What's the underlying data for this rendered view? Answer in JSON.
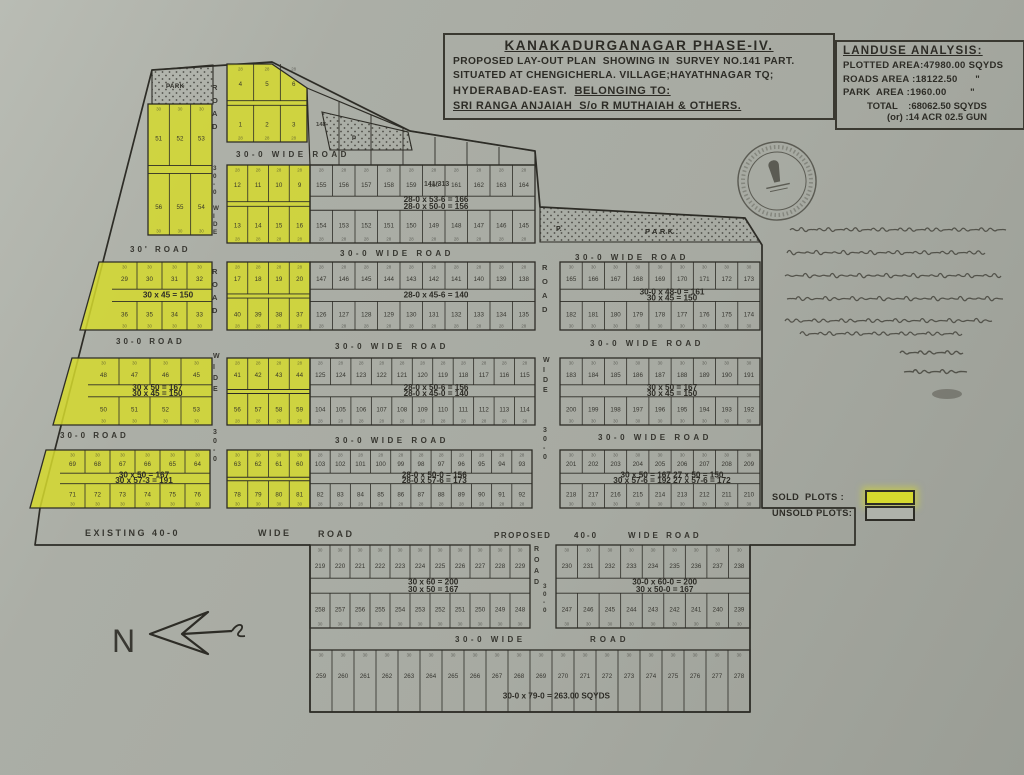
{
  "title_block": {
    "l1": "KANAKADURGANAGAR  PHASE-IV.",
    "l2": "PROPOSED LAY-OUT PLAN  SHOWING IN  SURVEY NO.141 PART.",
    "l3": "SITUATED AT CHENGICHERLA. VILLAGE;HAYATHNAGAR TQ;",
    "l4a": "HYDERABAD-EAST.  ",
    "l4b": "BELONGING TO:",
    "l5": "SRI RANGA ANJAIAH  S/o R MUTHAIAH & OTHERS."
  },
  "landuse": {
    "title": "LANDUSE ANALYSIS:",
    "rows": [
      "PLOTTED AREA:47980.00 SQYDS",
      "ROADS AREA :18122.50      \"",
      "PARK  AREA :1960.00        \""
    ],
    "total": "TOTAL    :68062.50 SQYDS",
    "alt": "(or) :14 ACR 02.5 GUN"
  },
  "legend": {
    "sold": "SOLD  PLOTS :",
    "unsold": "UNSOLD PLOTS:"
  },
  "compass": {
    "letter": "N"
  },
  "stamp": {
    "description": "circular official seal with pillar emblem"
  },
  "handwriting": {
    "description": "handwritten Telugu annotation referencing survey no.141, areas 47980, 18122.50, 1960.00 sq.yds, with signature and date",
    "lines": [
      [
        790,
        230,
        218
      ],
      [
        787,
        253,
        205
      ],
      [
        785,
        276,
        224
      ],
      [
        787,
        299,
        216
      ],
      [
        785,
        321,
        212
      ],
      [
        800,
        334,
        162
      ]
    ],
    "signature": [
      [
        900,
        353,
        70
      ],
      [
        904,
        372,
        64
      ]
    ]
  },
  "map": {
    "ink": "#2d2c26",
    "sold_color": "#d5d92e",
    "boundary": "M152,70 L272,62 L410,131 L535,151 L540,207 L745,218 L762,245 L762,508 L855,508 L855,545 L750,545 L750,712 L310,712 L310,545 L35,545 L40,508 Z",
    "parks": [
      {
        "pts": "152,70 213,65 213,104 152,104",
        "labels": [
          {
            "t": "PARK",
            "x": 166,
            "y": 88,
            "fs": 6,
            "ls": 0.5
          }
        ]
      },
      {
        "pts": "322,112 408,132 412,150 330,150",
        "labels": [
          {
            "t": "P",
            "x": 352,
            "y": 140,
            "fs": 6,
            "ls": 0
          }
        ]
      },
      {
        "pts": "540,207 745,218 760,242 540,242",
        "labels": [
          {
            "t": "P.",
            "x": 556,
            "y": 231,
            "fs": 7,
            "ls": 0
          },
          {
            "t": "PARK.",
            "x": 645,
            "y": 234,
            "fs": 7.5,
            "ls": 2.5
          }
        ]
      }
    ],
    "strip": {
      "pts": "307,88 410,131 535,151 535,165 310,165",
      "lines": [
        [
          339,
          102
        ],
        [
          371,
          115
        ],
        [
          403,
          128
        ],
        [
          435,
          137
        ],
        [
          467,
          142
        ],
        [
          499,
          147
        ]
      ],
      "y2": 165
    },
    "blocks": [
      {
        "n": "top-mid",
        "pts": "227,64 272,64 307,88 307,142 227,142",
        "gx": 227,
        "gy": 64,
        "gw": 80,
        "gh": 78,
        "cols": 3,
        "sold": 1,
        "front": "28",
        "rows": [
          [
            "4",
            "5",
            "6"
          ],
          [
            "1",
            "2",
            "3"
          ]
        ],
        "anns": []
      },
      {
        "n": "lb1",
        "gx": 148,
        "gy": 104,
        "gw": 64,
        "gh": 131,
        "cols": 3,
        "sold": 1,
        "front": "30",
        "rows": [
          [
            "51",
            "52",
            "53"
          ],
          [
            "56",
            "55",
            "54"
          ]
        ],
        "anns": []
      },
      {
        "n": "rowB-yellow",
        "gx": 227,
        "gy": 165,
        "gw": 83,
        "gh": 78,
        "cols": 4,
        "sold": 1,
        "front": "28",
        "rows": [
          [
            "12",
            "11",
            "10",
            "9"
          ],
          [
            "13",
            "14",
            "15",
            "16"
          ]
        ],
        "anns": []
      },
      {
        "n": "M2",
        "gx": 310,
        "gy": 165,
        "gw": 225,
        "gh": 78,
        "cols": 10,
        "front": "28",
        "rows": [
          [
            "155",
            "156",
            "157",
            "158",
            "159",
            "160",
            "161",
            "162",
            "163",
            "164"
          ],
          [
            "154",
            "153",
            "152",
            "151",
            "150",
            "149",
            "148",
            "147",
            "146",
            "145"
          ]
        ],
        "anns": [
          "28-0 x 53-6 = 166",
          "28-0 x 50-0 = 156"
        ]
      },
      {
        "n": "lb2",
        "pts": "99,262 212,262 212,330 80,330",
        "gx": 112,
        "gy": 262,
        "gw": 100,
        "gh": 68,
        "cols": 4,
        "sold": 1,
        "front": "30",
        "rows": [
          [
            "29",
            "30",
            "31",
            "32"
          ],
          [
            "36",
            "35",
            "34",
            "33"
          ]
        ],
        "anns": [
          "30 x 45 = 150"
        ]
      },
      {
        "n": "rowC-yellow",
        "gx": 227,
        "gy": 262,
        "gw": 83,
        "gh": 68,
        "cols": 4,
        "sold": 1,
        "front": "28",
        "rows": [
          [
            "17",
            "18",
            "19",
            "20"
          ],
          [
            "40",
            "39",
            "38",
            "37"
          ]
        ],
        "anns": []
      },
      {
        "n": "M3",
        "gx": 310,
        "gy": 262,
        "gw": 225,
        "gh": 68,
        "cols": 10,
        "front": "28",
        "rows": [
          [
            "147",
            "146",
            "145",
            "144",
            "143",
            "142",
            "141",
            "140",
            "139",
            "138"
          ],
          [
            "126",
            "127",
            "128",
            "129",
            "130",
            "131",
            "132",
            "133",
            "134",
            "135"
          ]
        ],
        "anns": [
          "28-0 x 45-6 = 140"
        ]
      },
      {
        "n": "RB1",
        "gx": 560,
        "gy": 262,
        "gw": 200,
        "gh": 68,
        "cols": 9,
        "front": "30",
        "rows": [
          [
            "165",
            "166",
            "167",
            "168",
            "169",
            "170",
            "171",
            "172",
            "173"
          ],
          [
            "182",
            "181",
            "180",
            "179",
            "178",
            "177",
            "176",
            "175",
            "174"
          ]
        ],
        "anns": [
          "30-0 x 48-0 = 161",
          "30 x 45 = 150"
        ]
      },
      {
        "n": "lb3",
        "pts": "72,358 212,358 212,425 53,425",
        "gx": 88,
        "gy": 358,
        "gw": 124,
        "gh": 67,
        "cols": 4,
        "sold": 1,
        "front": "30",
        "rows": [
          [
            "48",
            "47",
            "46",
            "45"
          ],
          [
            "50",
            "51",
            "52",
            "53"
          ]
        ],
        "anns": [
          "30 x 50 = 167",
          "30 x 45 = 150"
        ]
      },
      {
        "n": "rowD-yellow",
        "gx": 227,
        "gy": 358,
        "gw": 83,
        "gh": 67,
        "cols": 4,
        "sold": 1,
        "front": "28",
        "rows": [
          [
            "41",
            "42",
            "43",
            "44"
          ],
          [
            "56",
            "57",
            "58",
            "59"
          ]
        ],
        "anns": []
      },
      {
        "n": "M4",
        "gx": 310,
        "gy": 358,
        "gw": 225,
        "gh": 67,
        "cols": 11,
        "front": "28",
        "rows": [
          [
            "125",
            "124",
            "123",
            "122",
            "121",
            "120",
            "119",
            "118",
            "117",
            "116",
            "115"
          ],
          [
            "104",
            "105",
            "106",
            "107",
            "108",
            "109",
            "110",
            "111",
            "112",
            "113",
            "114"
          ]
        ],
        "anns": [
          "28-0 x 50-6 = 156",
          "28-0 x 45-0 = 140"
        ]
      },
      {
        "n": "RB2",
        "gx": 560,
        "gy": 358,
        "gw": 200,
        "gh": 67,
        "cols": 9,
        "front": "30",
        "rows": [
          [
            "183",
            "184",
            "185",
            "186",
            "187",
            "188",
            "189",
            "190",
            "191"
          ],
          [
            "200",
            "199",
            "198",
            "197",
            "196",
            "195",
            "194",
            "193",
            "192"
          ]
        ],
        "anns": [
          "30 x 50 = 167",
          "30 x 45 = 150"
        ]
      },
      {
        "n": "lb4",
        "pts": "46,450 210,450 210,508 30,508",
        "gx": 60,
        "gy": 450,
        "gw": 150,
        "gh": 58,
        "cols": 6,
        "sold": 1,
        "front": "30",
        "rows": [
          [
            "69",
            "68",
            "67",
            "66",
            "65",
            "64"
          ],
          [
            "71",
            "72",
            "73",
            "74",
            "75",
            "76"
          ]
        ],
        "anns": [
          "30 x 50 = 167",
          "30 x 57-3 = 191"
        ]
      },
      {
        "n": "lb5",
        "gx": 227,
        "gy": 450,
        "gw": 83,
        "gh": 58,
        "cols": 4,
        "sold": 1,
        "front": "30",
        "rows": [
          [
            "63",
            "62",
            "61",
            "60"
          ],
          [
            "78",
            "79",
            "80",
            "81"
          ]
        ],
        "anns": []
      },
      {
        "n": "M5",
        "gx": 310,
        "gy": 450,
        "gw": 222,
        "gh": 58,
        "cols": 11,
        "front": "28",
        "rows": [
          [
            "103",
            "102",
            "101",
            "100",
            "99",
            "98",
            "97",
            "96",
            "95",
            "94",
            "93"
          ],
          [
            "82",
            "83",
            "84",
            "85",
            "86",
            "87",
            "88",
            "89",
            "90",
            "91",
            "92"
          ]
        ],
        "anns": [
          "28-0 x 50-0 = 156",
          "28-0 x 57-6 = 173"
        ]
      },
      {
        "n": "RB3",
        "gx": 560,
        "gy": 450,
        "gw": 200,
        "gh": 58,
        "cols": 9,
        "front": "30",
        "rows": [
          [
            "201",
            "202",
            "203",
            "204",
            "205",
            "206",
            "207",
            "208",
            "209"
          ],
          [
            "218",
            "217",
            "216",
            "215",
            "214",
            "213",
            "212",
            "211",
            "210"
          ]
        ],
        "anns": [
          "30 x 50 = 167   27 x 50 = 150",
          "30 x 57-6 = 192  27 x 57-6 = 172"
        ]
      },
      {
        "n": "BB1",
        "gx": 310,
        "gy": 545,
        "gw": 220,
        "gh": 83,
        "cols": 11,
        "front": "30",
        "rows": [
          [
            "219",
            "220",
            "221",
            "222",
            "223",
            "224",
            "225",
            "226",
            "227",
            "228",
            "229"
          ],
          [
            "258",
            "257",
            "256",
            "255",
            "254",
            "253",
            "252",
            "251",
            "250",
            "249",
            "248"
          ]
        ],
        "anns": [
          "30 x 60 = 200",
          "30 x 50 = 167"
        ]
      },
      {
        "n": "BB2",
        "gx": 556,
        "gy": 545,
        "gw": 194,
        "gh": 83,
        "cols": 9,
        "front": "30",
        "rows": [
          [
            "230",
            "231",
            "232",
            "233",
            "234",
            "235",
            "236",
            "237",
            "238"
          ],
          [
            "247",
            "246",
            "245",
            "244",
            "243",
            "242",
            "241",
            "240",
            "239"
          ]
        ],
        "anns": [
          "30-0 x 60-0 = 200",
          "30 x 50-0 = 167"
        ]
      },
      {
        "n": "BB3",
        "gx": 310,
        "gy": 650,
        "gw": 440,
        "gh": 62,
        "cols": 20,
        "front": "30",
        "rows": [
          [
            "259",
            "260",
            "261",
            "262",
            "263",
            "264",
            "265",
            "266",
            "267",
            "268",
            "269",
            "270",
            "271",
            "272",
            "273",
            "274",
            "275",
            "276",
            "277",
            "278"
          ]
        ],
        "anns": [
          "30-0 x 79-0 = 263.00 SQYDS"
        ]
      }
    ],
    "road_labels": [
      {
        "t": "30-0  WIDE  ROAD",
        "x": 236,
        "y": 157,
        "fs": 8,
        "ls": 3.5
      },
      {
        "t": "30'  ROAD",
        "x": 130,
        "y": 252,
        "fs": 8,
        "ls": 3
      },
      {
        "t": "30-0  WIDE  ROAD",
        "x": 340,
        "y": 256,
        "fs": 8,
        "ls": 3.5
      },
      {
        "t": "30-0  WIDE  ROAD",
        "x": 575,
        "y": 260,
        "fs": 8,
        "ls": 3.5
      },
      {
        "t": "30-0  ROAD",
        "x": 116,
        "y": 344,
        "fs": 8,
        "ls": 3
      },
      {
        "t": "30-0  WIDE  ROAD",
        "x": 335,
        "y": 349,
        "fs": 8,
        "ls": 3.5
      },
      {
        "t": "30-0  WIDE  ROAD",
        "x": 590,
        "y": 346,
        "fs": 8,
        "ls": 3.5
      },
      {
        "t": "30-0  ROAD",
        "x": 60,
        "y": 438,
        "fs": 8,
        "ls": 3
      },
      {
        "t": "30-0  WIDE  ROAD",
        "x": 335,
        "y": 443,
        "fs": 8,
        "ls": 3.5
      },
      {
        "t": "30-0  WIDE  ROAD",
        "x": 598,
        "y": 440,
        "fs": 8,
        "ls": 3.5
      },
      {
        "t": "EXISTING  40-0",
        "x": 85,
        "y": 536,
        "fs": 9,
        "ls": 2.5
      },
      {
        "t": "WIDE",
        "x": 258,
        "y": 536,
        "fs": 9,
        "ls": 2.5
      },
      {
        "t": "ROAD",
        "x": 318,
        "y": 537,
        "fs": 9,
        "ls": 2.5
      },
      {
        "t": "PROPOSED",
        "x": 494,
        "y": 538,
        "fs": 8,
        "ls": 1.5
      },
      {
        "t": "40-0",
        "x": 574,
        "y": 538,
        "fs": 8,
        "ls": 2
      },
      {
        "t": "WIDE  ROAD",
        "x": 628,
        "y": 538,
        "fs": 8,
        "ls": 3
      },
      {
        "t": "30-0  WIDE",
        "x": 455,
        "y": 642,
        "fs": 8,
        "ls": 3.5
      },
      {
        "t": "ROAD",
        "x": 590,
        "y": 642,
        "fs": 8,
        "ls": 4
      },
      {
        "t": "ROAD",
        "x": 212,
        "y": 90,
        "fs": 7.5,
        "vert": 1,
        "step": 13
      },
      {
        "t": "30-0 WIDE",
        "x": 213,
        "y": 170,
        "fs": 6.3,
        "vert": 1,
        "step": 8
      },
      {
        "t": "ROAD",
        "x": 212,
        "y": 274,
        "fs": 7.5,
        "vert": 1,
        "step": 13
      },
      {
        "t": "WIDE",
        "x": 213,
        "y": 358,
        "fs": 7,
        "vert": 1,
        "step": 11
      },
      {
        "t": "30-0",
        "x": 213,
        "y": 434,
        "fs": 7,
        "vert": 1,
        "step": 9
      },
      {
        "t": "ROAD",
        "x": 542,
        "y": 270,
        "fs": 7.5,
        "vert": 1,
        "step": 14
      },
      {
        "t": "WIDE",
        "x": 543,
        "y": 362,
        "fs": 7,
        "vert": 1,
        "step": 10
      },
      {
        "t": "30-0",
        "x": 543,
        "y": 432,
        "fs": 7,
        "vert": 1,
        "step": 9
      },
      {
        "t": "ROAD",
        "x": 534,
        "y": 551,
        "fs": 7,
        "vert": 1,
        "step": 11
      },
      {
        "t": "30-0",
        "x": 543,
        "y": 588,
        "fs": 6.3,
        "vert": 1,
        "step": 8
      }
    ],
    "labels": [
      {
        "t": "141/313",
        "x": 424,
        "y": 186,
        "fs": 7
      },
      {
        "t": "148",
        "x": 316,
        "y": 126,
        "fs": 6
      }
    ]
  }
}
